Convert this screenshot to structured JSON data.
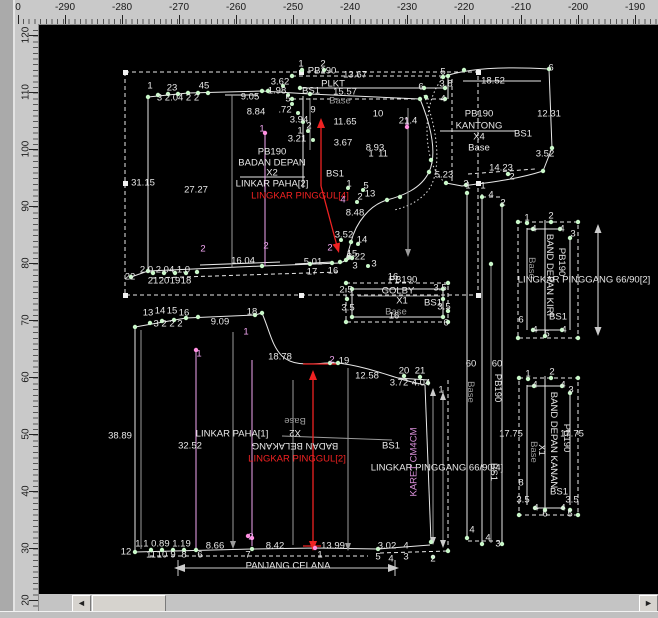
{
  "app": {
    "canvas_bg": "#000000",
    "ruler_bg": "#c9c9c9",
    "line_white": "#e8e8e8",
    "line_gray": "#9c9c9c",
    "point_green": "#c9f7c9",
    "pink": "#f2a6f2",
    "accent_red": "#ee2222"
  },
  "rulers": {
    "top": {
      "labels": [
        {
          "t": "0",
          "c": 18
        },
        {
          "t": "-290",
          "c": 65
        },
        {
          "t": "-280",
          "c": 122
        },
        {
          "t": "-270",
          "c": 179
        },
        {
          "t": "-260",
          "c": 236
        },
        {
          "t": "-250",
          "c": 293
        },
        {
          "t": "-240",
          "c": 350
        },
        {
          "t": "-230",
          "c": 407
        },
        {
          "t": "-220",
          "c": 464
        },
        {
          "t": "-210",
          "c": 521
        },
        {
          "t": "-200",
          "c": 578
        },
        {
          "t": "-190",
          "c": 635
        }
      ]
    },
    "left": {
      "labels": [
        {
          "t": "120",
          "c": 35
        },
        {
          "t": "110",
          "c": 92
        },
        {
          "t": "100",
          "c": 149
        },
        {
          "t": "90",
          "c": 206
        },
        {
          "t": "80",
          "c": 263
        },
        {
          "t": "70",
          "c": 320
        },
        {
          "t": "60",
          "c": 377
        },
        {
          "t": "50",
          "c": 434
        },
        {
          "t": "40",
          "c": 491
        },
        {
          "t": "30",
          "c": 548
        },
        {
          "t": "20",
          "c": 600
        }
      ]
    }
  },
  "scrollbar": {
    "left_arrow": "◄",
    "right_arrow": "►"
  },
  "canvas": {
    "annotations": [
      {
        "t": "1",
        "x": 150,
        "y": 86
      },
      {
        "t": "23",
        "x": 172,
        "y": 88
      },
      {
        "t": "45",
        "x": 204,
        "y": 86
      },
      {
        "t": "3 2.04 2 2",
        "x": 178,
        "y": 98
      },
      {
        "t": "9.05",
        "x": 250,
        "y": 97
      },
      {
        "t": "6",
        "x": 421,
        "y": 87
      },
      {
        "t": "1",
        "x": 407,
        "y": 122,
        "c": "p"
      },
      {
        "t": "8.84",
        "x": 256,
        "y": 112
      },
      {
        "t": ".72",
        "x": 285,
        "y": 110
      },
      {
        "t": "9",
        "x": 313,
        "y": 110
      },
      {
        "t": "3.62",
        "x": 280,
        "y": 82
      },
      {
        "t": "1.98",
        "x": 277,
        "y": 91
      },
      {
        "t": "5",
        "x": 288,
        "y": 99
      },
      {
        "t": "3.94",
        "x": 299,
        "y": 120
      },
      {
        "t": "2",
        "x": 309,
        "y": 126
      },
      {
        "t": "1",
        "x": 300,
        "y": 131
      },
      {
        "t": "3.21",
        "x": 297,
        "y": 139
      },
      {
        "t": "11.65",
        "x": 345,
        "y": 122
      },
      {
        "t": "3.67",
        "x": 343,
        "y": 143
      },
      {
        "t": "8.93",
        "x": 375,
        "y": 148
      },
      {
        "t": "10",
        "x": 378,
        "y": 114
      },
      {
        "t": "21.4",
        "x": 408,
        "y": 121
      },
      {
        "t": "1",
        "x": 371,
        "y": 154
      },
      {
        "t": "11",
        "x": 383,
        "y": 154
      },
      {
        "t": "PB190",
        "x": 272,
        "y": 152
      },
      {
        "t": "BADAN DEPAN",
        "x": 272,
        "y": 163
      },
      {
        "t": "X2",
        "x": 272,
        "y": 173
      },
      {
        "t": "LINKAR PAHA[2]",
        "x": 272,
        "y": 184
      },
      {
        "t": "LINGKAR PINGGUL[4]",
        "x": 300,
        "y": 196,
        "c": "r"
      },
      {
        "t": "BS1",
        "x": 335,
        "y": 174
      },
      {
        "t": "31.15",
        "x": 143,
        "y": 183
      },
      {
        "t": "27.27",
        "x": 196,
        "y": 190
      },
      {
        "t": "1",
        "x": 262,
        "y": 129,
        "c": "p"
      },
      {
        "t": "5",
        "x": 366,
        "y": 186
      },
      {
        "t": "1",
        "x": 349,
        "y": 184
      },
      {
        "t": "2",
        "x": 360,
        "y": 197
      },
      {
        "t": "13",
        "x": 370,
        "y": 194
      },
      {
        "t": "4",
        "x": 343,
        "y": 200,
        "c": "p"
      },
      {
        "t": "8.48",
        "x": 355,
        "y": 213
      },
      {
        "t": "3.52",
        "x": 344,
        "y": 235
      },
      {
        "t": "14",
        "x": 362,
        "y": 240
      },
      {
        "t": "15",
        "x": 352,
        "y": 254
      },
      {
        "t": "8.22",
        "x": 356,
        "y": 257
      },
      {
        "t": "3",
        "x": 374,
        "y": 264
      },
      {
        "t": "5.01",
        "x": 313,
        "y": 262
      },
      {
        "t": "17",
        "x": 312,
        "y": 272
      },
      {
        "t": "16",
        "x": 333,
        "y": 271
      },
      {
        "t": "2",
        "x": 330,
        "y": 248,
        "c": "p"
      },
      {
        "t": "16.04",
        "x": 243,
        "y": 261
      },
      {
        "t": "2",
        "x": 203,
        "y": 249,
        "c": "p"
      },
      {
        "t": "2",
        "x": 266,
        "y": 246,
        "c": "p"
      },
      {
        "t": "22",
        "x": 130,
        "y": 277
      },
      {
        "t": "2.0 2.04 1.0",
        "x": 165,
        "y": 270
      },
      {
        "t": "21",
        "x": 153,
        "y": 281
      },
      {
        "t": "20",
        "x": 164,
        "y": 281
      },
      {
        "t": "19",
        "x": 175,
        "y": 281
      },
      {
        "t": "18",
        "x": 186,
        "y": 281
      },
      {
        "t": "1",
        "x": 301,
        "y": 64
      },
      {
        "t": "2",
        "x": 323,
        "y": 64
      },
      {
        "t": "PB190",
        "x": 322,
        "y": 71
      },
      {
        "t": "13.67",
        "x": 355,
        "y": 75
      },
      {
        "t": "PLKT",
        "x": 333,
        "y": 84
      },
      {
        "t": "BS1",
        "x": 311,
        "y": 91
      },
      {
        "t": "15.57",
        "x": 345,
        "y": 92
      },
      {
        "t": "Base",
        "x": 340,
        "y": 101,
        "c": "g"
      },
      {
        "t": "3.8",
        "x": 446,
        "y": 84
      },
      {
        "t": "4",
        "x": 443,
        "y": 99
      },
      {
        "t": "5",
        "x": 443,
        "y": 72
      },
      {
        "t": "6",
        "x": 551,
        "y": 68
      },
      {
        "t": "18.52",
        "x": 493,
        "y": 81
      },
      {
        "t": "12.31",
        "x": 549,
        "y": 114
      },
      {
        "t": "PB190",
        "x": 479,
        "y": 114
      },
      {
        "t": "KANTONG",
        "x": 479,
        "y": 126
      },
      {
        "t": "X4",
        "x": 479,
        "y": 137
      },
      {
        "t": "Base",
        "x": 479,
        "y": 148
      },
      {
        "t": "BS1",
        "x": 523,
        "y": 134
      },
      {
        "t": "3.52",
        "x": 545,
        "y": 154
      },
      {
        "t": "14.23",
        "x": 501,
        "y": 168
      },
      {
        "t": "5.23",
        "x": 444,
        "y": 175
      },
      {
        "t": "1",
        "x": 468,
        "y": 186
      },
      {
        "t": "2",
        "x": 512,
        "y": 177
      },
      {
        "t": "16",
        "x": 393,
        "y": 277
      },
      {
        "t": "PB190",
        "x": 403,
        "y": 280
      },
      {
        "t": "GOLBY",
        "x": 398,
        "y": 291
      },
      {
        "t": "X1",
        "x": 402,
        "y": 301
      },
      {
        "t": "Base",
        "x": 396,
        "y": 312,
        "c": "g"
      },
      {
        "t": "16",
        "x": 394,
        "y": 316
      },
      {
        "t": "BS1",
        "x": 433,
        "y": 303
      },
      {
        "t": "2.5",
        "x": 346,
        "y": 290
      },
      {
        "t": "3.5",
        "x": 348,
        "y": 308
      },
      {
        "t": "3.5",
        "x": 440,
        "y": 288
      },
      {
        "t": "3.5",
        "x": 444,
        "y": 307
      },
      {
        "t": "6",
        "x": 446,
        "y": 323
      },
      {
        "t": "3",
        "x": 355,
        "y": 266
      },
      {
        "t": "3",
        "x": 466,
        "y": 184
      },
      {
        "t": "1",
        "x": 483,
        "y": 186
      },
      {
        "t": "4",
        "x": 491,
        "y": 195
      },
      {
        "t": "2",
        "x": 503,
        "y": 203
      },
      {
        "t": "60",
        "x": 471,
        "y": 364
      },
      {
        "t": "60",
        "x": 497,
        "y": 364
      },
      {
        "t": "Base",
        "x": 470,
        "y": 392,
        "rot": 90,
        "c": "g"
      },
      {
        "t": "PB190",
        "x": 497,
        "y": 388,
        "rot": 90
      },
      {
        "t": "BS1",
        "x": 493,
        "y": 472,
        "rot": 90
      },
      {
        "t": "4",
        "x": 472,
        "y": 530
      },
      {
        "t": "4",
        "x": 488,
        "y": 538
      },
      {
        "t": "3",
        "x": 498,
        "y": 544
      },
      {
        "t": "1",
        "x": 527,
        "y": 218
      },
      {
        "t": "2",
        "x": 551,
        "y": 216
      },
      {
        "t": "3",
        "x": 573,
        "y": 234
      },
      {
        "t": "4",
        "x": 534,
        "y": 229
      },
      {
        "t": "4",
        "x": 562,
        "y": 229
      },
      {
        "t": "Base",
        "x": 531,
        "y": 268,
        "rot": 90,
        "c": "g"
      },
      {
        "t": "BAND DEPAN KIRI",
        "x": 549,
        "y": 275,
        "rot": 90
      },
      {
        "t": "PB190",
        "x": 561,
        "y": 262,
        "rot": 90
      },
      {
        "t": "BS1",
        "x": 558,
        "y": 317
      },
      {
        "t": "LINGKAR PINGGANG 66/90[2]",
        "x": 584,
        "y": 280
      },
      {
        "t": "6",
        "x": 521,
        "y": 320
      },
      {
        "t": "5",
        "x": 547,
        "y": 334
      },
      {
        "t": "4",
        "x": 535,
        "y": 330
      },
      {
        "t": "4",
        "x": 564,
        "y": 330
      },
      {
        "t": "1",
        "x": 528,
        "y": 374
      },
      {
        "t": "2",
        "x": 552,
        "y": 372
      },
      {
        "t": "3",
        "x": 571,
        "y": 390
      },
      {
        "t": "4",
        "x": 535,
        "y": 385
      },
      {
        "t": "4",
        "x": 563,
        "y": 385
      },
      {
        "t": "17.75",
        "x": 511,
        "y": 434
      },
      {
        "t": "17.75",
        "x": 572,
        "y": 434
      },
      {
        "t": "Base",
        "x": 533,
        "y": 452,
        "rot": 90,
        "c": "g"
      },
      {
        "t": "X1",
        "x": 541,
        "y": 450,
        "rot": 90
      },
      {
        "t": "BAND DEPAN KANAN",
        "x": 553,
        "y": 440,
        "rot": 90
      },
      {
        "t": "PB190",
        "x": 566,
        "y": 438,
        "rot": 90
      },
      {
        "t": "BS1",
        "x": 559,
        "y": 492
      },
      {
        "t": "8",
        "x": 521,
        "y": 483
      },
      {
        "t": "3.5",
        "x": 523,
        "y": 500
      },
      {
        "t": "3.5",
        "x": 572,
        "y": 500
      },
      {
        "t": "4",
        "x": 536,
        "y": 508
      },
      {
        "t": "4",
        "x": 563,
        "y": 508
      },
      {
        "t": "6",
        "x": 545,
        "y": 514
      },
      {
        "t": "5",
        "x": 570,
        "y": 514
      },
      {
        "t": "13",
        "x": 148,
        "y": 313
      },
      {
        "t": "14",
        "x": 160,
        "y": 311
      },
      {
        "t": "15",
        "x": 172,
        "y": 311
      },
      {
        "t": "16",
        "x": 184,
        "y": 313
      },
      {
        "t": "3 2 2 2",
        "x": 168,
        "y": 324
      },
      {
        "t": "9.09",
        "x": 220,
        "y": 322
      },
      {
        "t": "18",
        "x": 252,
        "y": 312
      },
      {
        "t": "1",
        "x": 246,
        "y": 332,
        "c": "p"
      },
      {
        "t": "18.78",
        "x": 280,
        "y": 357
      },
      {
        "t": "2",
        "x": 332,
        "y": 360,
        "c": "p"
      },
      {
        "t": "19",
        "x": 344,
        "y": 361
      },
      {
        "t": "12.58",
        "x": 367,
        "y": 376
      },
      {
        "t": "20",
        "x": 404,
        "y": 371
      },
      {
        "t": "21",
        "x": 420,
        "y": 371
      },
      {
        "t": "3.72",
        "x": 399,
        "y": 383
      },
      {
        "t": "4.04",
        "x": 421,
        "y": 383
      },
      {
        "t": "1",
        "x": 441,
        "y": 390
      },
      {
        "t": "38.89",
        "x": 120,
        "y": 436
      },
      {
        "t": "32.52",
        "x": 190,
        "y": 446
      },
      {
        "t": "LINKAR PAHA[1]",
        "x": 232,
        "y": 434
      },
      {
        "t": "Base",
        "x": 295,
        "y": 420,
        "rot": 180,
        "c": "g"
      },
      {
        "t": "X2",
        "x": 295,
        "y": 432,
        "rot": 180
      },
      {
        "t": "BADAN BELAKANG",
        "x": 295,
        "y": 445,
        "rot": 180
      },
      {
        "t": "LINGKAR PINGGUL[2]",
        "x": 297,
        "y": 459,
        "c": "r"
      },
      {
        "t": "BS1",
        "x": 391,
        "y": 446
      },
      {
        "t": "LINGKAR PINGGANG 66/90[4]",
        "x": 437,
        "y": 468
      },
      {
        "t": "KARET CM4CM",
        "x": 414,
        "y": 462,
        "rot": -90,
        "c": "m"
      },
      {
        "t": "1",
        "x": 199,
        "y": 354,
        "c": "p"
      },
      {
        "t": "12",
        "x": 126,
        "y": 552
      },
      {
        "t": "1.1 0.89 1.19",
        "x": 163,
        "y": 544
      },
      {
        "t": "11",
        "x": 151,
        "y": 555
      },
      {
        "t": "10",
        "x": 162,
        "y": 555
      },
      {
        "t": "9",
        "x": 173,
        "y": 555
      },
      {
        "t": "8",
        "x": 184,
        "y": 555
      },
      {
        "t": "6",
        "x": 200,
        "y": 555
      },
      {
        "t": "8.66",
        "x": 215,
        "y": 546
      },
      {
        "t": "2",
        "x": 251,
        "y": 537,
        "c": "p"
      },
      {
        "t": "7",
        "x": 248,
        "y": 555
      },
      {
        "t": "8.42",
        "x": 275,
        "y": 546
      },
      {
        "t": "1",
        "x": 320,
        "y": 555
      },
      {
        "t": "13.99",
        "x": 333,
        "y": 546
      },
      {
        "t": "3.02",
        "x": 387,
        "y": 546
      },
      {
        "t": "4",
        "x": 406,
        "y": 546
      },
      {
        "t": "5",
        "x": 378,
        "y": 557
      },
      {
        "t": "4",
        "x": 391,
        "y": 559
      },
      {
        "t": "3",
        "x": 406,
        "y": 557
      },
      {
        "t": "2",
        "x": 433,
        "y": 559
      },
      {
        "t": "PANJANG CELANA",
        "x": 288,
        "y": 566
      }
    ]
  }
}
